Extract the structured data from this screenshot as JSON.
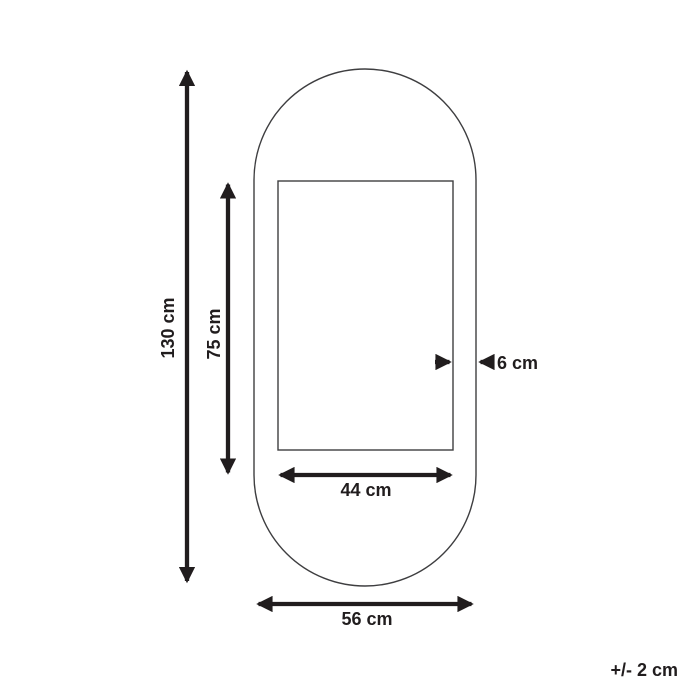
{
  "diagram": {
    "dimensions": {
      "overall_height": {
        "label": "130 cm",
        "value": 130,
        "unit": "cm",
        "orientation": "vertical"
      },
      "inner_height": {
        "label": "75 cm",
        "value": 75,
        "unit": "cm",
        "orientation": "vertical"
      },
      "frame_depth": {
        "label": "6 cm",
        "value": 6,
        "unit": "cm",
        "orientation": "horizontal"
      },
      "inner_width": {
        "label": "44 cm",
        "value": 44,
        "unit": "cm",
        "orientation": "horizontal"
      },
      "overall_width": {
        "label": "56 cm",
        "value": 56,
        "unit": "cm",
        "orientation": "horizontal"
      }
    },
    "tolerance": {
      "label": "+/- 2 cm"
    }
  },
  "colors": {
    "ink": "#211d1e",
    "outline": "#3e3e40",
    "background": "#ffffff"
  }
}
